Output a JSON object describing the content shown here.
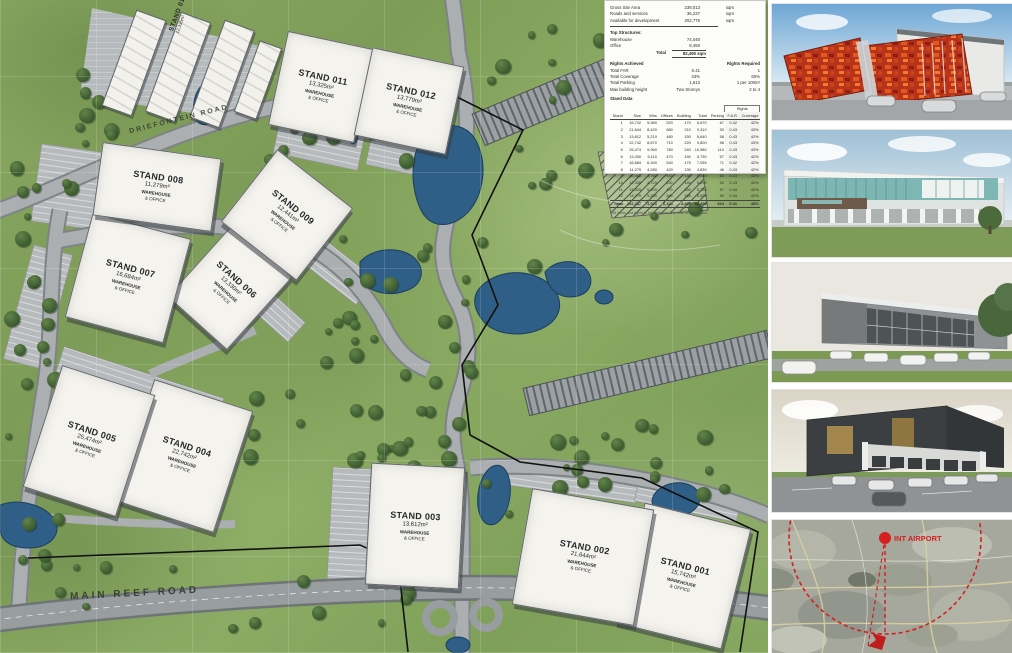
{
  "masterplan": {
    "roads": {
      "main_reef": "MAIN REEF ROAD",
      "driefontein": "DRIEFONTEIN ROAD"
    },
    "stand_use": {
      "line1": "WAREHOUSE",
      "line2": "& OFFICE"
    },
    "stands": [
      {
        "id": "001",
        "name": "STAND 001",
        "area": "15,742m²",
        "use1": "WAREHOUSE",
        "use2": "& OFFICE"
      },
      {
        "id": "002",
        "name": "STAND 002",
        "area": "21,644m²",
        "use1": "WAREHOUSE",
        "use2": "& OFFICE"
      },
      {
        "id": "003",
        "name": "STAND 003",
        "area": "13,612m²",
        "use1": "WAREHOUSE",
        "use2": "& OFFICE"
      },
      {
        "id": "004",
        "name": "STAND 004",
        "area": "22,742m²",
        "use1": "WAREHOUSE",
        "use2": "& OFFICE"
      },
      {
        "id": "005",
        "name": "STAND 005",
        "area": "25,474m²",
        "use1": "WAREHOUSE",
        "use2": "& OFFICE"
      },
      {
        "id": "006",
        "name": "STAND 006",
        "area": "13,330m²",
        "use1": "WAREHOUSE",
        "use2": "& OFFICE"
      },
      {
        "id": "007",
        "name": "STAND 007",
        "area": "16,684m²",
        "use1": "WAREHOUSE",
        "use2": "& OFFICE"
      },
      {
        "id": "008",
        "name": "STAND 008",
        "area": "11,279m²",
        "use1": "WAREHOUSE",
        "use2": "& OFFICE"
      },
      {
        "id": "009",
        "name": "STAND 009",
        "area": "12,441m²",
        "use1": "WAREHOUSE",
        "use2": "& OFFICE"
      },
      {
        "id": "010",
        "name": "STAND 010",
        "area": "12,335m²",
        "use1": "",
        "use2": ""
      },
      {
        "id": "011",
        "name": "STAND 011",
        "area": "13,325m²",
        "use1": "WAREHOUSE",
        "use2": "& OFFICE"
      },
      {
        "id": "012",
        "name": "STAND 012",
        "area": "13,779m²",
        "use1": "WAREHOUSE",
        "use2": "& OFFICE"
      }
    ]
  },
  "info_panel": {
    "summary_rows": [
      [
        "Gross Site Area",
        "239,013",
        "sqm"
      ],
      [
        "Roads and services",
        "36,237",
        "sqm"
      ],
      [
        "Available for development",
        "202,776",
        "sqm"
      ]
    ],
    "top_structures": {
      "title": "Top Structures:",
      "rows": [
        [
          "Warehouse",
          "74,040"
        ],
        [
          "Office",
          "8,450"
        ]
      ],
      "total_label": "Total",
      "total_value": "82,490 sqm"
    },
    "rights": {
      "achieved_header": "Rights Achieved",
      "required_header": "Rights Required",
      "rows": [
        [
          "Total FAR",
          "0.41",
          "1"
        ],
        [
          "Total Coverage",
          "43%",
          "60%"
        ],
        [
          "Total Parking",
          "1,613",
          "1 per 100m²"
        ],
        [
          "Max building height",
          "Two Storeys",
          "2 to 4"
        ]
      ]
    },
    "stand_table": {
      "title": "Stand Data",
      "rights_group": "Rights",
      "columns": [
        "Stand",
        "Size",
        "Whs",
        "Offices",
        "Building",
        "Total",
        "Parking",
        "F.A.R",
        "Coverage"
      ],
      "rows": [
        [
          "1",
          "15,742",
          "5,980",
          "520",
          "170",
          "6,670",
          "67",
          "0.42",
          "42%"
        ],
        [
          "2",
          "21,644",
          "8,420",
          "680",
          "210",
          "9,310",
          "93",
          "0.43",
          "43%"
        ],
        [
          "3",
          "13,612",
          "5,210",
          "480",
          "150",
          "5,840",
          "58",
          "0.43",
          "42%"
        ],
        [
          "4",
          "22,742",
          "8,870",
          "710",
          "220",
          "9,800",
          "98",
          "0.43",
          "43%"
        ],
        [
          "5",
          "25,474",
          "9,960",
          "780",
          "240",
          "10,980",
          "110",
          "0.43",
          "43%"
        ],
        [
          "6",
          "13,330",
          "5,110",
          "470",
          "150",
          "5,730",
          "57",
          "0.43",
          "42%"
        ],
        [
          "7",
          "16,684",
          "6,340",
          "540",
          "175",
          "7,055",
          "71",
          "0.42",
          "42%"
        ],
        [
          "8",
          "11,279",
          "4,280",
          "420",
          "130",
          "4,830",
          "48",
          "0.43",
          "42%"
        ],
        [
          "9",
          "12,441",
          "4,760",
          "440",
          "140",
          "5,340",
          "53",
          "0.43",
          "42%"
        ],
        [
          "10",
          "12,335",
          "4,720",
          "430",
          "140",
          "5,290",
          "53",
          "0.43",
          "42%"
        ],
        [
          "11",
          "13,325",
          "5,100",
          "470",
          "150",
          "5,720",
          "57",
          "0.43",
          "42%"
        ],
        [
          "12",
          "13,779",
          "5,290",
          "480",
          "155",
          "5,925",
          "59",
          "0.43",
          "42%"
        ]
      ],
      "total_row": [
        "Total",
        "192,387",
        "74,040",
        "6,420",
        "2,030",
        "82,490",
        "824",
        "0.41",
        "43%"
      ],
      "footnote": "* All areas and rights to be confirmed with final SDP approval."
    }
  },
  "location_map": {
    "airport_label": "INT AIRPORT"
  },
  "colors": {
    "water": "#2f5e86",
    "road": "#abafb2",
    "stand_fill": "#f4f3ee",
    "boundary": "#111111",
    "map_red": "#d42020",
    "accent_red_facade": "#b8321c"
  }
}
